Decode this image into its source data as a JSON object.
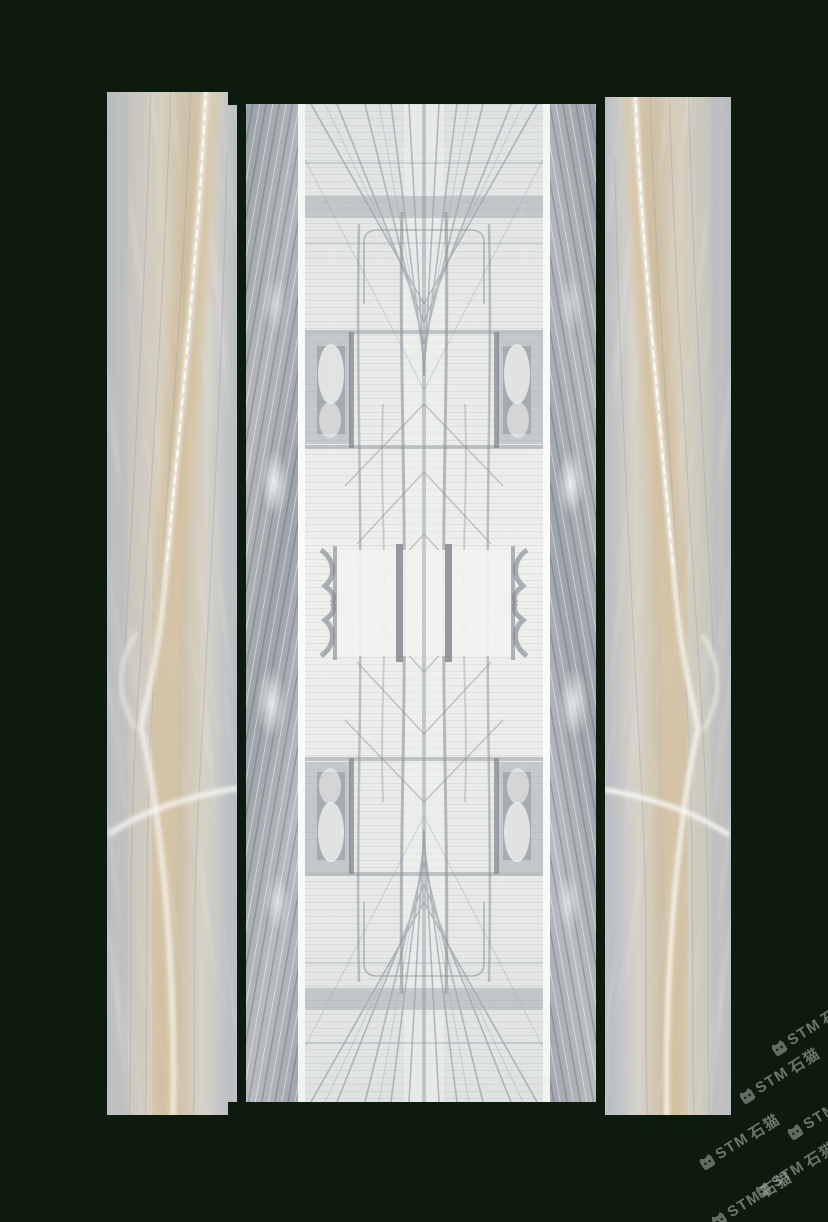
{
  "image": {
    "description": "Product photo: bookmatched grey-beige marble background wall (center) flanked by two vertical-grain marble slabs on a dark green backdrop",
    "background_color": "#0c1b0e"
  },
  "panels": {
    "left_slab_label": "left marble slab",
    "center_wall_label": "bookmatched marble feature wall",
    "right_slab_label": "right marble slab",
    "trim_label": "white trim stripe"
  },
  "watermark": {
    "brand_latin": "STM",
    "brand_cn": "石猫",
    "logo_icon": "cat-logo-icon",
    "color": "#a8b69e",
    "instance_count": 6,
    "area": "bottom-right corner, diagonal tiling"
  },
  "palette": {
    "background": "#0c1b0e",
    "marble_grey": "#b7bcc2",
    "marble_beige": "#d7cfbe",
    "marble_tan": "#cec1a9",
    "inner_light": "#edeeec",
    "trim_white": "#f7f8f5",
    "vein_dark": "#8b9199",
    "watermark_green": "#a8b69e"
  }
}
